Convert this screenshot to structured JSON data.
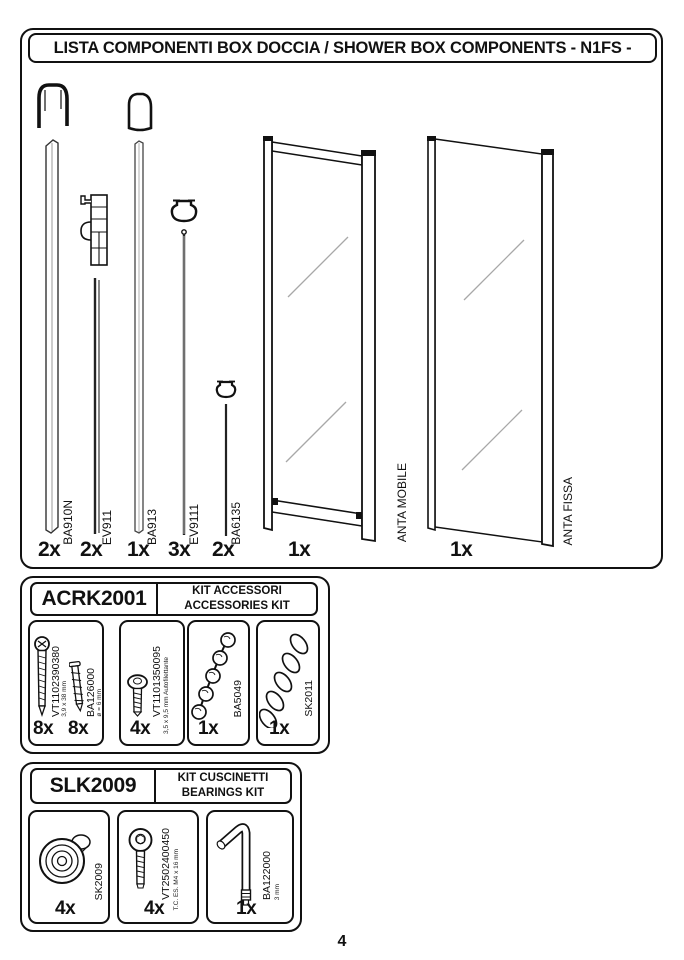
{
  "page_number": "4",
  "main": {
    "title": "LISTA COMPONENTI BOX DOCCIA / SHOWER BOX COMPONENTS - N1FS -",
    "components": [
      {
        "code": "BA910N",
        "qty": "2x"
      },
      {
        "code": "EV911",
        "qty": "2x"
      },
      {
        "code": "BA913",
        "qty": "1x"
      },
      {
        "code": "EV9111",
        "qty": "3x"
      },
      {
        "code": "BA6135",
        "qty": "2x"
      },
      {
        "code": "ANTA MOBILE",
        "qty": "1x"
      },
      {
        "code": "ANTA FISSA",
        "qty": "1x"
      }
    ]
  },
  "kits": [
    {
      "code": "ACRK2001",
      "title_it": "KIT ACCESSORI",
      "title_en": "ACCESSORIES KIT",
      "items": [
        {
          "code": "VT1102390380",
          "spec": "3,9 x 38 mm",
          "qty": "8x"
        },
        {
          "code": "BA126000",
          "spec": "ø = 6 mm",
          "qty": "8x"
        },
        {
          "code": "VT1101350095",
          "spec": "3,5 x 9,5 mm Autofilettante",
          "qty": "4x"
        },
        {
          "code": "BA5049",
          "spec": "",
          "qty": "1x"
        },
        {
          "code": "SK2011",
          "spec": "",
          "qty": "1x"
        }
      ]
    },
    {
      "code": "SLK2009",
      "title_it": "KIT CUSCINETTI",
      "title_en": "BEARINGS KIT",
      "items": [
        {
          "code": "SK2009",
          "spec": "",
          "qty": "4x"
        },
        {
          "code": "VT2502400450",
          "spec": "T.C. ES. M4 x 16 mm",
          "qty": "4x"
        },
        {
          "code": "BA122000",
          "spec": "3 mm",
          "qty": "1x"
        }
      ]
    }
  ]
}
